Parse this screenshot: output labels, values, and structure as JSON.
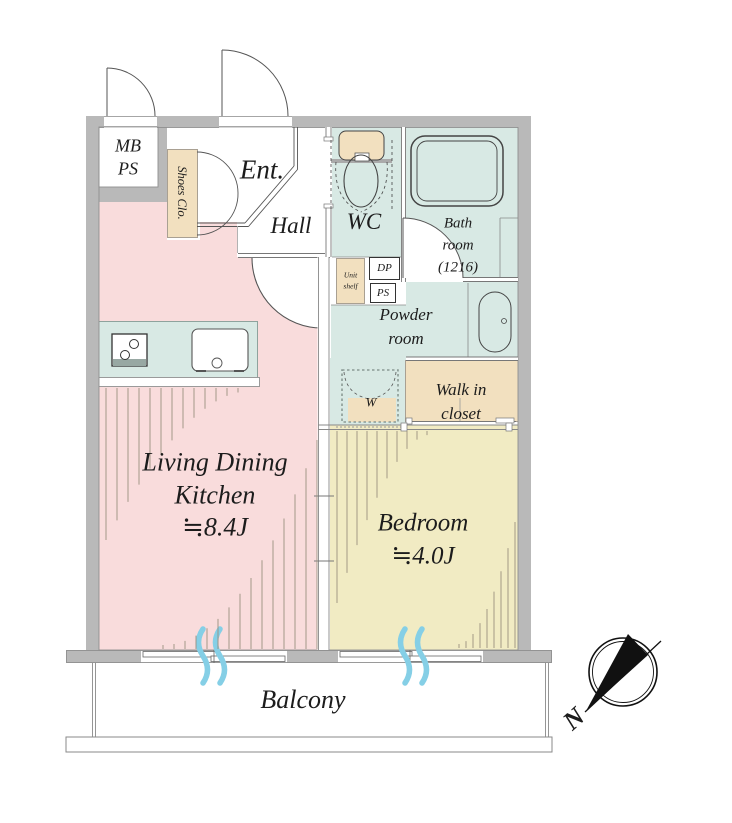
{
  "colors": {
    "wall": "#b9b9b9",
    "pink": "#f9dcdc",
    "cream": "#f1ebc3",
    "teal": "#d8e9e4",
    "tan": "#f2e0bf",
    "blue": "#85cfe6",
    "hatch": "#9a8f7e",
    "line": "#555555"
  },
  "rooms": {
    "mbps": {
      "line1": "MB",
      "line2": "PS"
    },
    "shoes_closet": {
      "label": "Shoes Clo."
    },
    "entrance": {
      "label": "Ent."
    },
    "hall": {
      "label": "Hall"
    },
    "wc": {
      "label": "WC"
    },
    "bathroom": {
      "line1": "Bath",
      "line2": "room",
      "line3": "(1216)"
    },
    "unit_shelf": {
      "line1": "Unit",
      "line2": "shelf"
    },
    "dp": {
      "label": "DP"
    },
    "ps": {
      "label": "PS"
    },
    "powder_room": {
      "line1": "Powder",
      "line2": "room"
    },
    "washer": {
      "label": "W"
    },
    "walk_in_closet": {
      "line1": "Walk in",
      "line2": "closet"
    },
    "ldk": {
      "line1": "Living Dining",
      "line2": "Kitchen",
      "line3": "≒8.4J"
    },
    "bedroom": {
      "line1": "Bedroom",
      "line2": "≒4.0J"
    },
    "balcony": {
      "label": "Balcony"
    }
  },
  "compass": {
    "label": "N"
  }
}
